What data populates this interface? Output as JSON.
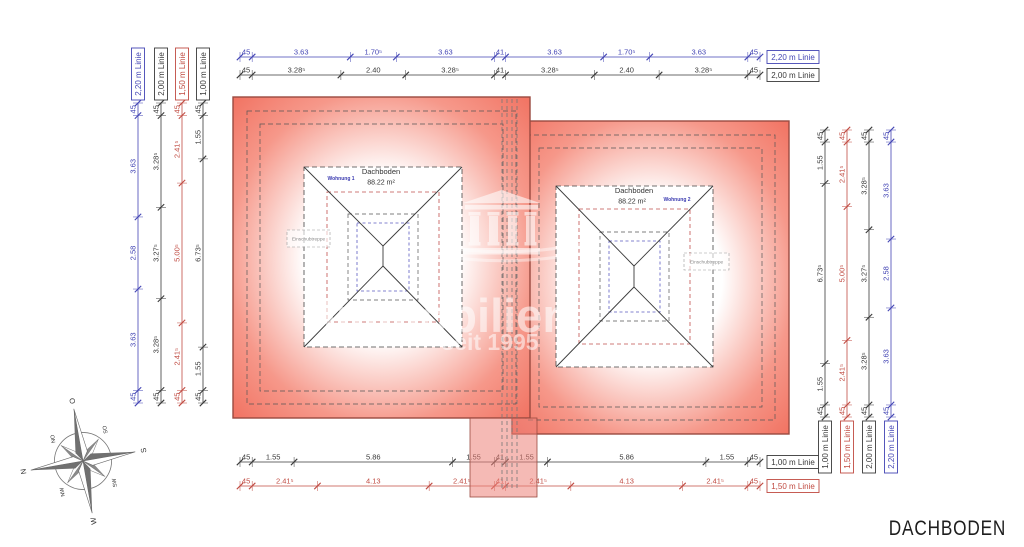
{
  "page_title": "DACHBODEN",
  "colors": {
    "blue": "#4345b4",
    "black": "#3a3a3a",
    "red": "#c04b42"
  },
  "plan": {
    "left_wing": {
      "room": "Dachboden",
      "area": "88.22 m²",
      "unit": "Wohnung 1",
      "stair": "Einschubtreppe"
    },
    "right_wing": {
      "room": "Dachboden",
      "area": "88.22 m²",
      "unit": "Wohnung 2",
      "stair": "Einschubtreppe"
    }
  },
  "watermark": {
    "brand": "Immobilien",
    "since": "seit 1995"
  },
  "compass": {
    "cardinals": [
      "N",
      "O",
      "S",
      "W"
    ],
    "intercardinals": [
      "NO",
      "SO",
      "SW",
      "NW"
    ]
  },
  "dimensions": {
    "top": [
      {
        "color": "blue",
        "box": "2,20 m Linie",
        "segments": [
          [
            "45",
            0.45
          ],
          [
            "3.63",
            3.63
          ],
          [
            "1.70⁵",
            1.705
          ],
          [
            "3.63",
            3.63
          ],
          [
            "41",
            0.41
          ],
          [
            "3.63",
            3.63
          ],
          [
            "1.70⁵",
            1.705
          ],
          [
            "3.63",
            3.63
          ],
          [
            "45",
            0.45
          ]
        ]
      },
      {
        "color": "black",
        "box": "2,00 m Linie",
        "segments": [
          [
            "45",
            0.45
          ],
          [
            "3.28⁵",
            3.285
          ],
          [
            "2.40",
            2.4
          ],
          [
            "3.28⁵",
            3.285
          ],
          [
            "41",
            0.41
          ],
          [
            "3.28⁵",
            3.285
          ],
          [
            "2.40",
            2.4
          ],
          [
            "3.28⁵",
            3.285
          ],
          [
            "45",
            0.45
          ]
        ]
      }
    ],
    "bottom": [
      {
        "color": "black",
        "box": "1,00 m Linie",
        "segments": [
          [
            "45",
            0.45
          ],
          [
            "1.55",
            1.55
          ],
          [
            "5.86",
            5.86
          ],
          [
            "1.55",
            1.55
          ],
          [
            "41",
            0.41
          ],
          [
            "1.55",
            1.55
          ],
          [
            "5.86",
            5.86
          ],
          [
            "1.55",
            1.55
          ],
          [
            "45",
            0.45
          ]
        ]
      },
      {
        "color": "red",
        "box": "1,50 m Linie",
        "segments": [
          [
            "45",
            0.45
          ],
          [
            "2.41⁵",
            2.415
          ],
          [
            "4.13",
            4.13
          ],
          [
            "2.41⁵",
            2.415
          ],
          [
            "41",
            0.41
          ],
          [
            "2.41⁵",
            2.415
          ],
          [
            "4.13",
            4.13
          ],
          [
            "2.41⁵",
            2.415
          ],
          [
            "45",
            0.45
          ]
        ]
      }
    ],
    "left": [
      {
        "color": "blue",
        "box": "2,20 m Linie",
        "segments": [
          [
            "45",
            0.45
          ],
          [
            "3.63",
            3.63
          ],
          [
            "2.58",
            2.58
          ],
          [
            "3.63",
            3.63
          ],
          [
            "45",
            0.45
          ]
        ]
      },
      {
        "color": "black",
        "box": "2,00 m Linie",
        "segments": [
          [
            "45",
            0.45
          ],
          [
            "3.28⁵",
            3.285
          ],
          [
            "3.27⁵",
            3.275
          ],
          [
            "3.28⁵",
            3.285
          ],
          [
            "45",
            0.45
          ]
        ]
      },
      {
        "color": "red",
        "box": "1,50 m Linie",
        "segments": [
          [
            "45",
            0.45
          ],
          [
            "2.41⁵",
            2.415
          ],
          [
            "5.00⁵",
            5.005
          ],
          [
            "2.41⁵",
            2.415
          ],
          [
            "45",
            0.45
          ]
        ]
      },
      {
        "color": "black",
        "box": "1,00 m Linie",
        "segments": [
          [
            "45",
            0.45
          ],
          [
            "1.55",
            1.55
          ],
          [
            "6.73⁵",
            6.735
          ],
          [
            "1.55",
            1.55
          ],
          [
            "45",
            0.45
          ]
        ]
      }
    ],
    "right": [
      {
        "color": "black",
        "box": "1,00 m Linie",
        "segments": [
          [
            "45",
            0.45
          ],
          [
            "1.55",
            1.55
          ],
          [
            "6.73⁵",
            6.735
          ],
          [
            "1.55",
            1.55
          ],
          [
            "45",
            0.45
          ]
        ]
      },
      {
        "color": "red",
        "box": "1,50 m Linie",
        "segments": [
          [
            "45",
            0.45
          ],
          [
            "2.41⁵",
            2.415
          ],
          [
            "5.00⁵",
            5.005
          ],
          [
            "2.41⁵",
            2.415
          ],
          [
            "45",
            0.45
          ]
        ]
      },
      {
        "color": "black",
        "box": "2,00 m Linie",
        "segments": [
          [
            "45",
            0.45
          ],
          [
            "3.28⁵",
            3.285
          ],
          [
            "3.27⁵",
            3.275
          ],
          [
            "3.28⁵",
            3.285
          ],
          [
            "45",
            0.45
          ]
        ]
      },
      {
        "color": "blue",
        "box": "2,20 m Linie",
        "segments": [
          [
            "45",
            0.45
          ],
          [
            "3.63",
            3.63
          ],
          [
            "2.58",
            2.58
          ],
          [
            "3.63",
            3.63
          ],
          [
            "45",
            0.45
          ]
        ]
      }
    ]
  }
}
